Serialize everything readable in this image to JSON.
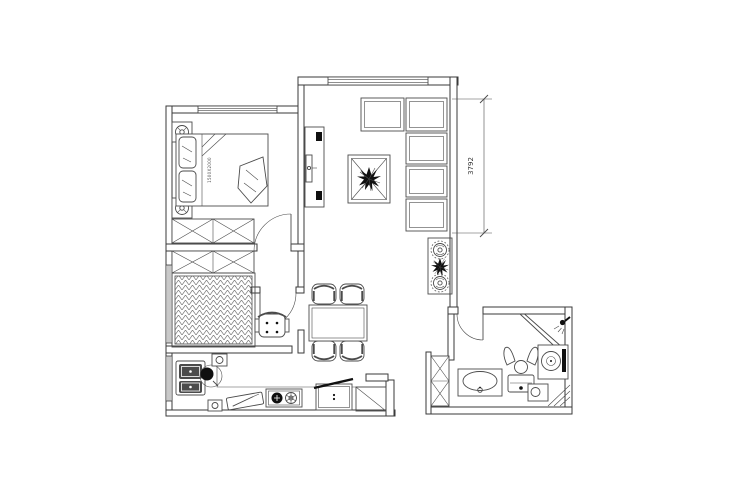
{
  "plan": {
    "dimension_label": "3792",
    "bed_label": "1500X2000"
  },
  "colors": {
    "wall": "#3a3a3a",
    "line": "#4b4b4b",
    "ink": "#101010",
    "hatch": "#7a7a7a",
    "background": "#ffffff"
  }
}
